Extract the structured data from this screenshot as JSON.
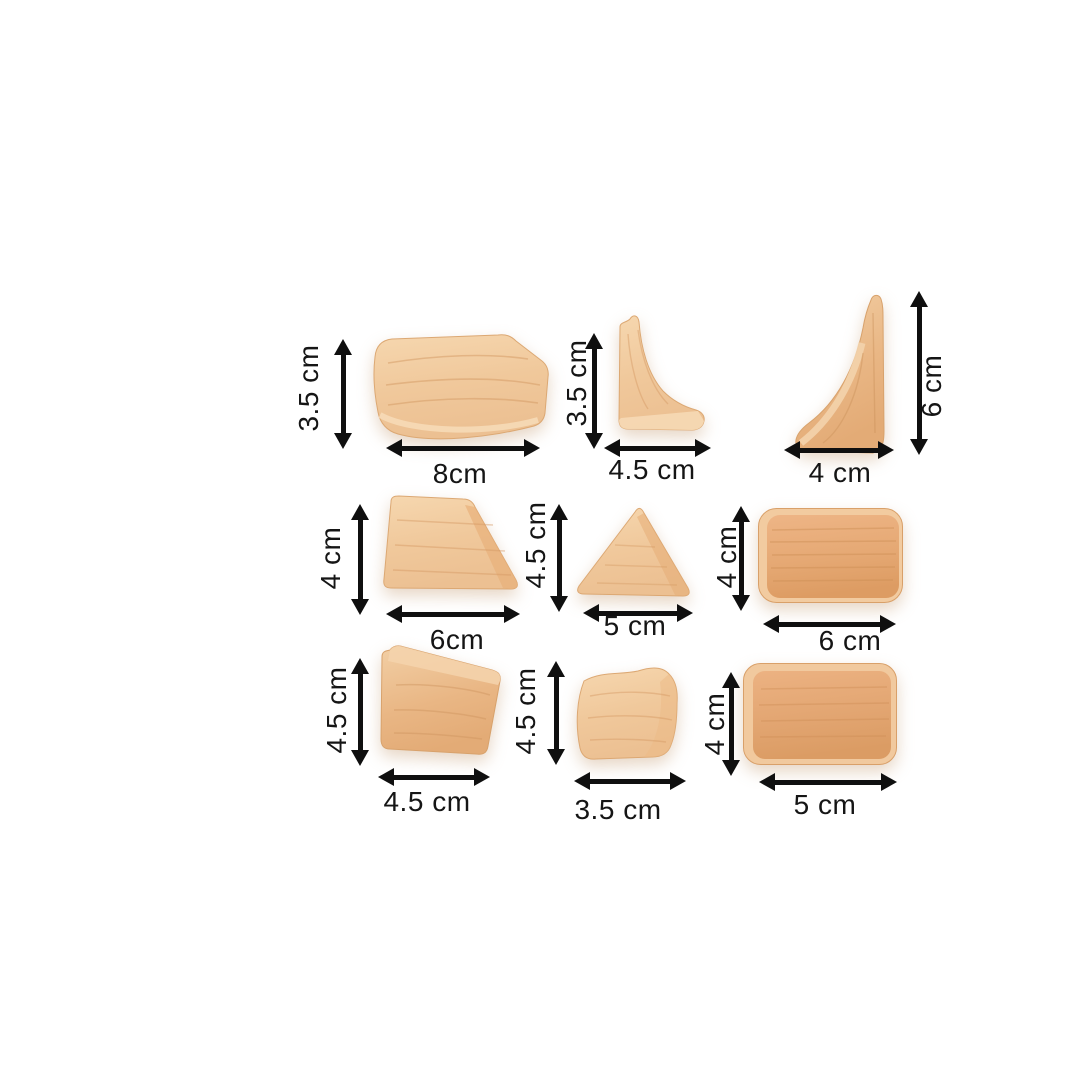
{
  "page": {
    "background_color": "#ffffff",
    "arrow_color": "#0f0f0f",
    "text_color": "#151515",
    "wood_light_color": "#f0c89b",
    "wood_dark_color": "#e5a873"
  },
  "blocks": [
    {
      "id": "curved-plank",
      "height_label": "3.5 cm",
      "width_label": "8cm"
    },
    {
      "id": "concave-corner-small",
      "height_label": "3.5 cm",
      "width_label": "4.5 cm"
    },
    {
      "id": "concave-corner-tall",
      "height_label": "6 cm",
      "width_label": "4 cm"
    },
    {
      "id": "right-trapezoid",
      "height_label": "4 cm",
      "width_label": "6cm"
    },
    {
      "id": "triangle",
      "height_label": "4.5 cm",
      "width_label": "5 cm"
    },
    {
      "id": "wide-rounded-rectangle",
      "height_label": "4 cm",
      "width_label": "6 cm"
    },
    {
      "id": "wedge-block",
      "height_label": "4.5 cm",
      "width_label": "4.5 cm"
    },
    {
      "id": "curved-square",
      "height_label": "4.5 cm",
      "width_label": "3.5 cm"
    },
    {
      "id": "rounded-rectangle",
      "height_label": "4 cm",
      "width_label": "5 cm"
    }
  ]
}
